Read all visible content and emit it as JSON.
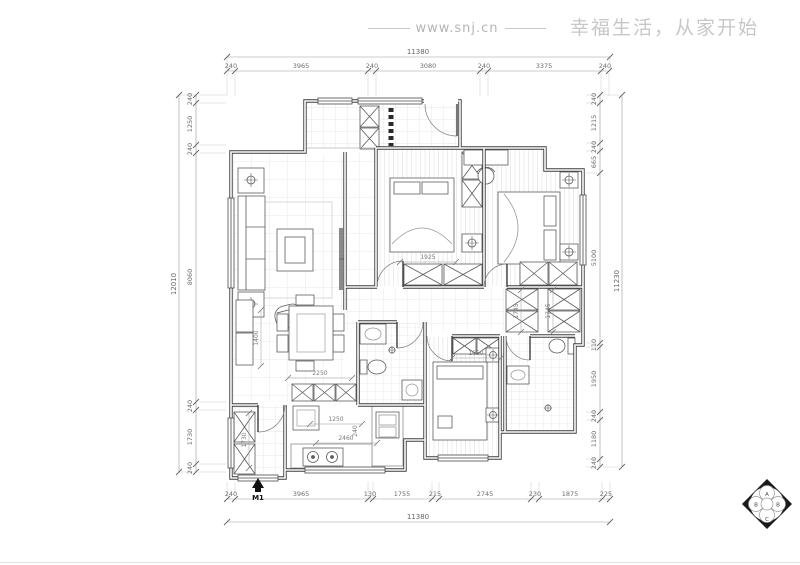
{
  "watermark": {
    "site": "www.snj.cn",
    "slogan": "幸福生活，从家开始"
  },
  "entry_marker": {
    "label": "M1"
  },
  "logo": {
    "letters": [
      "A",
      "B",
      "B",
      "C"
    ]
  },
  "dims": {
    "top": {
      "total": "11380",
      "segments": [
        "240",
        "3965",
        "240",
        "3080",
        "240",
        "3375",
        "240"
      ]
    },
    "bottom": {
      "total": "11380",
      "segments": [
        "240",
        "3965",
        "130",
        "1755",
        "215",
        "2745",
        "230",
        "1875",
        "225"
      ]
    },
    "left": {
      "total": "12010",
      "segments": [
        "240",
        "1250",
        "240",
        "8060",
        "240",
        "1730",
        "240"
      ]
    },
    "right": {
      "total": "11230",
      "segments": [
        "240",
        "1215",
        "240",
        "665",
        "5100",
        "110",
        "1950",
        "240",
        "1180",
        "240"
      ]
    },
    "interior": {
      "bed1_width": "1925",
      "closet_left": "1745",
      "closet_right": "1745",
      "wardrobe_b3": "1650",
      "dining_width": "2250",
      "kitchen_width": "1250",
      "kitchen_depth": "2460",
      "wall_thickness": "240",
      "sideboard_length": "1400",
      "cabinet_length": "1730"
    }
  }
}
